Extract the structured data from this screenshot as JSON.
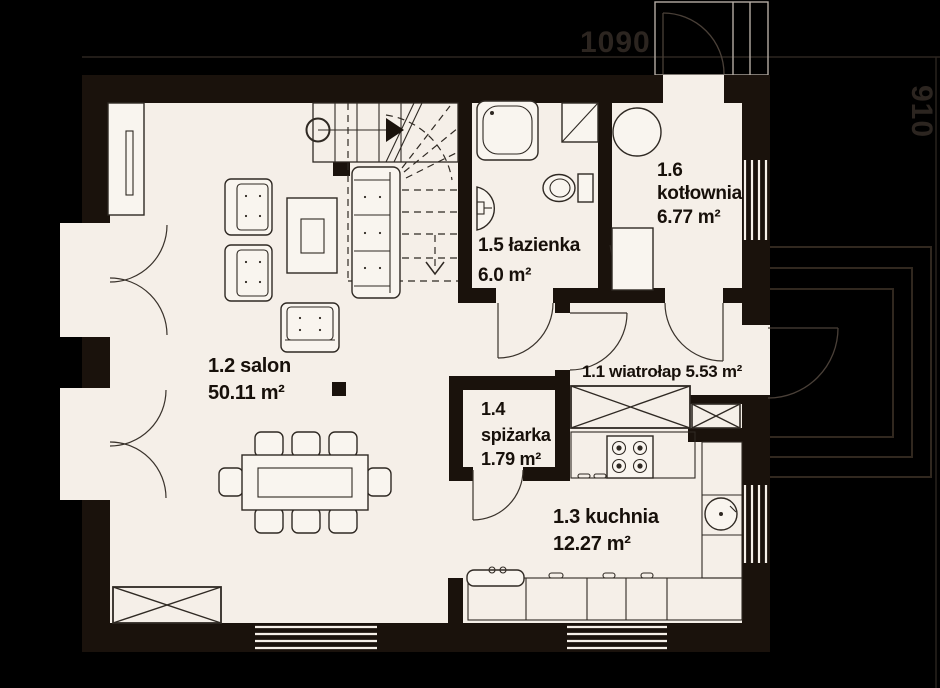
{
  "plan": {
    "title": "house ground floor plan",
    "dimensions": {
      "width_label": "1090",
      "height_label": "910"
    },
    "rooms": {
      "hall": {
        "label": "1.1 wiatrołap 5.53 m²"
      },
      "salon": {
        "name": "1.2 salon",
        "area": "50.11 m²"
      },
      "kitchen": {
        "name": "1.3 kuchnia",
        "area": "12.27 m²"
      },
      "pantry": {
        "number": "1.4",
        "name": "spiżarka",
        "area": "1.79 m²"
      },
      "bathroom": {
        "name": "1.5 łazienka",
        "area": "6.0 m²"
      },
      "boiler": {
        "number": "1.6",
        "name": "kotłownia",
        "area": "6.77 m²"
      }
    },
    "colors": {
      "background": "#000000",
      "floor": "#f5efe8",
      "wall": "#1a120c",
      "label_text": "#17100a",
      "dimension_text": "#2c2520"
    }
  }
}
